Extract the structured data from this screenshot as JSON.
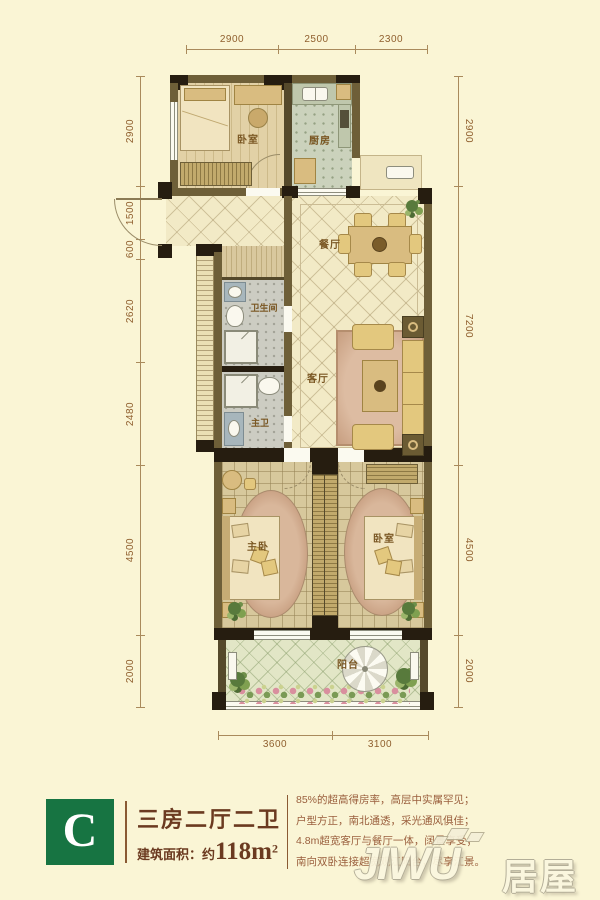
{
  "plan": {
    "dimensions": {
      "top": [
        "2900",
        "2500",
        "2300"
      ],
      "left": [
        "2900",
        "1500",
        "600",
        "2620",
        "2480",
        "4500",
        "2000"
      ],
      "right": [
        "2900",
        "7200",
        "4500",
        "2000"
      ],
      "bottom": [
        "3600",
        "3100"
      ]
    },
    "rooms": {
      "bedroom_north": "卧室",
      "kitchen": "厨房",
      "dining": "餐厅",
      "bath": "卫生间",
      "living": "客厅",
      "master_bath": "主卫",
      "master_bedroom": "主卧",
      "bedroom_south": "卧室",
      "balcony": "阳台"
    }
  },
  "card": {
    "unit_letter": "C",
    "unit_title": "三房二厅二卫",
    "area_prefix": "建筑面积：约",
    "area_value": "118m",
    "area_sup": "2",
    "description": [
      "85%的超高得房率，高层中实属罕见；",
      "户型方正，南北通透，采光通风俱佳；",
      "4.8m超宽客厅与餐厅一体，阔景享受；",
      "南向双卧连接超宽观江阳台，尽享江景。"
    ],
    "colors": {
      "green": "#177442",
      "brown": "#6B3A20",
      "desc": "#9A5F3D"
    }
  },
  "watermark": {
    "latin": "JIWU",
    "cjk": "居屋"
  }
}
